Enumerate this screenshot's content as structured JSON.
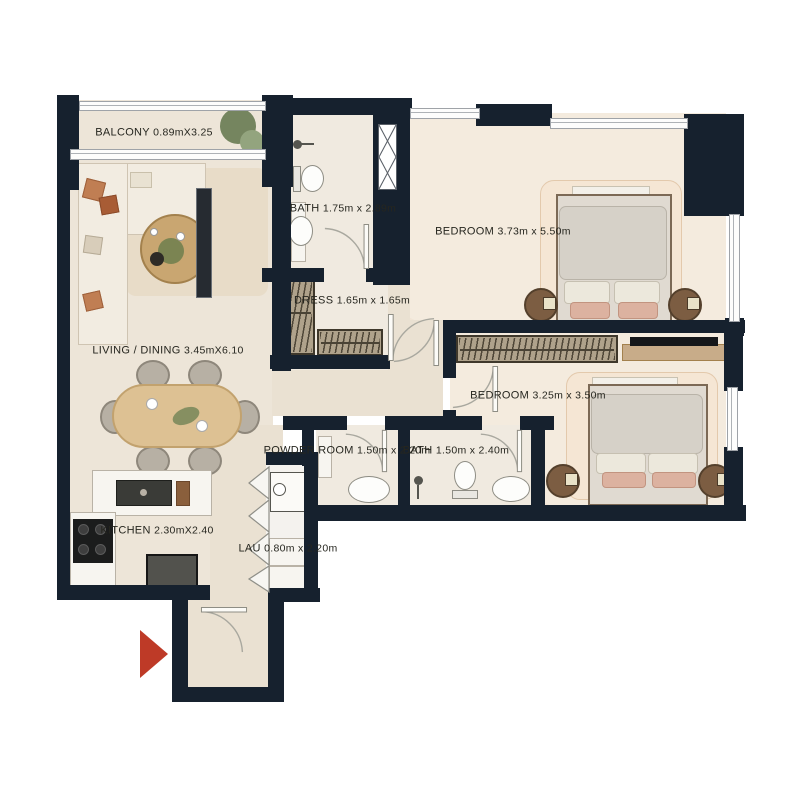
{
  "colors": {
    "wall": "#16212E",
    "floor": "#EDE5D8",
    "floor_marble": "#F4EBDE",
    "floor_bath": "#F0EAE0",
    "accent_red": "#BE3A27"
  },
  "rooms": [
    {
      "id": "balcony",
      "name": "BALCONY",
      "dims": "0.89mX3.25"
    },
    {
      "id": "living",
      "name": "LIVING / DINING",
      "dims": "3.45mX6.10"
    },
    {
      "id": "bath1",
      "name": "BATH",
      "dims": "1.75m x 2.89m"
    },
    {
      "id": "dress",
      "name": "DRESS",
      "dims": "1.65m x 1.65m"
    },
    {
      "id": "bedroom1",
      "name": "BEDROOM",
      "dims": "3.73m x 5.50m"
    },
    {
      "id": "bedroom2",
      "name": "BEDROOM",
      "dims": "3.25m x 3.50m"
    },
    {
      "id": "powder",
      "name": "POWDER ROOM",
      "dims": "1.50m x 2.20m"
    },
    {
      "id": "bath2",
      "name": "BATH",
      "dims": "1.50m x 2.40m"
    },
    {
      "id": "kitchen",
      "name": "KITCHEN",
      "dims": "2.30mX2.40"
    },
    {
      "id": "laundry",
      "name": "LAU",
      "dims": "0.80m x 2.20m"
    }
  ]
}
